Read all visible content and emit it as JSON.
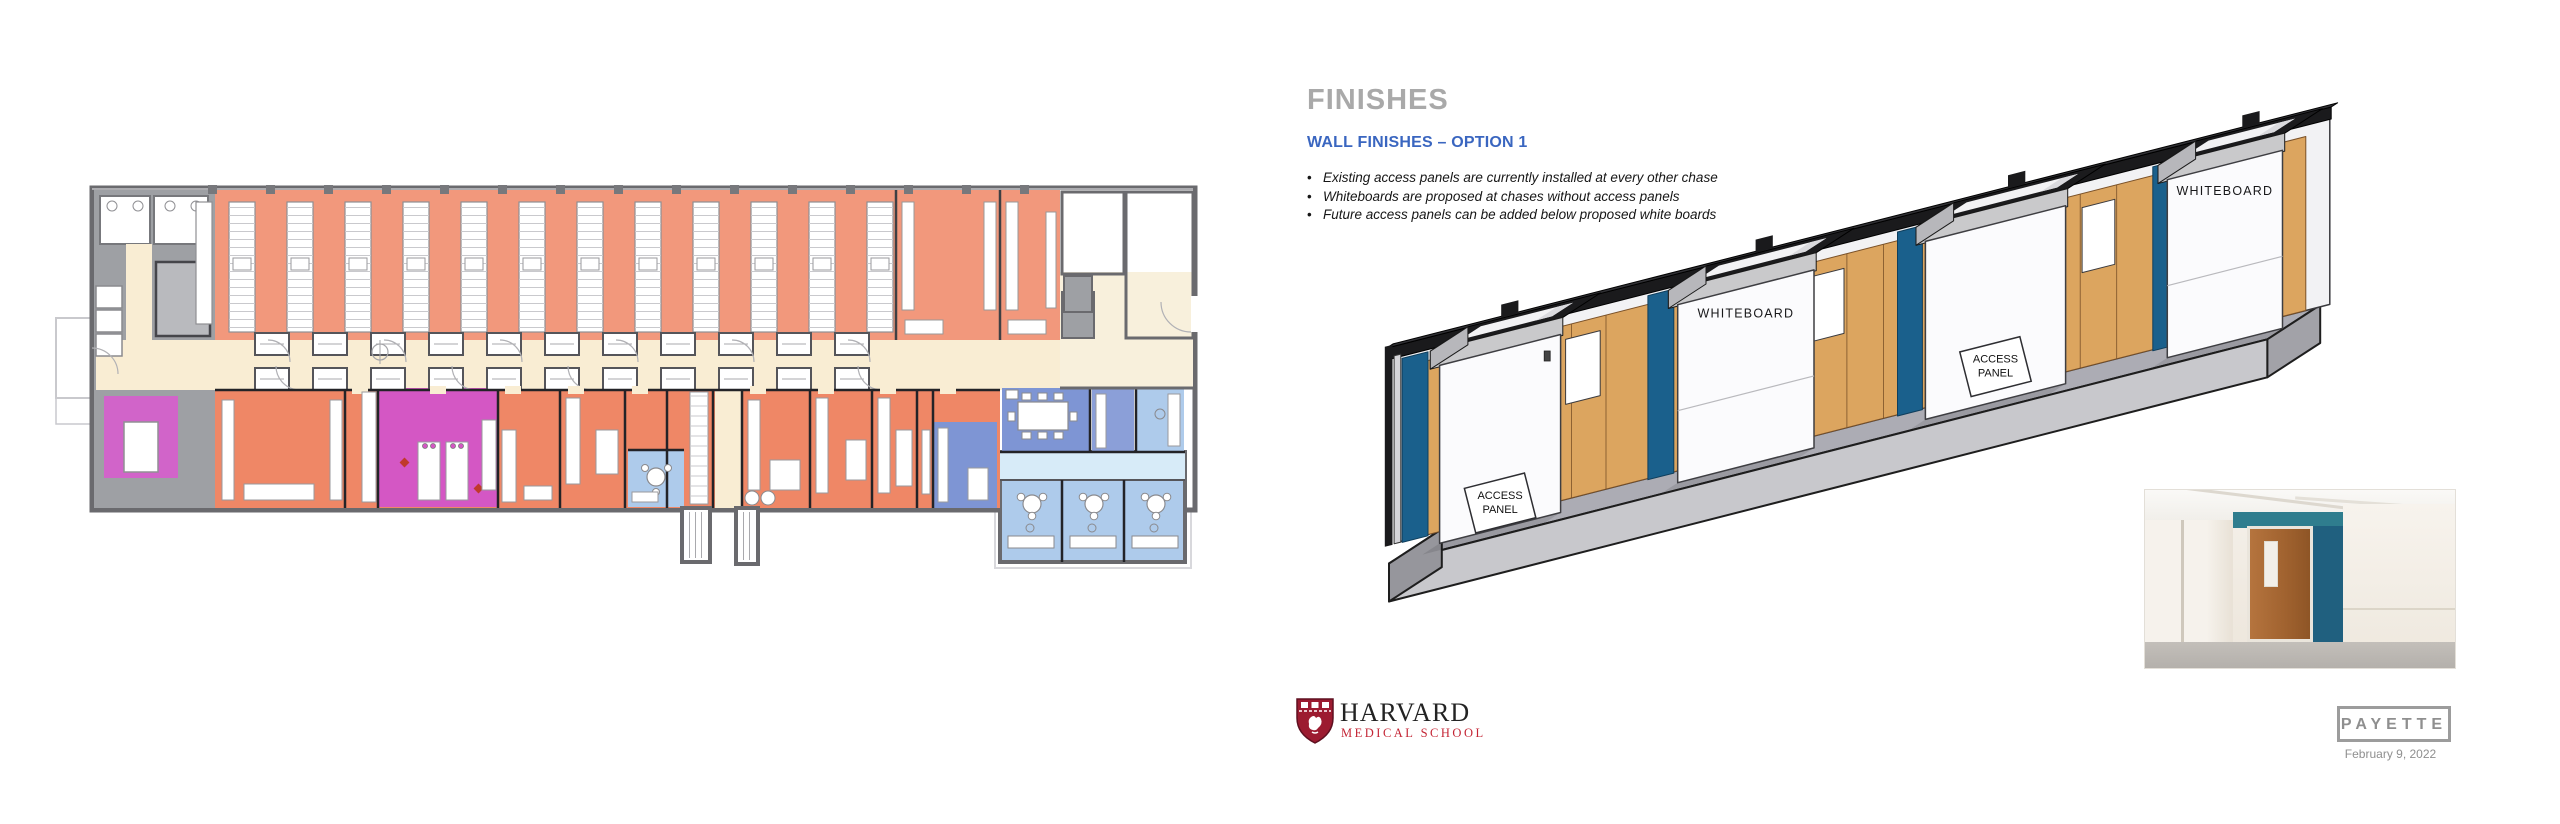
{
  "header": {
    "title": "FINISHES",
    "subtitle": "WALL FINISHES – OPTION 1",
    "bullets": [
      "Existing access panels are currently installed at every other chase",
      "Whiteboards are proposed at chases without access panels",
      "Future access panels can be added below proposed white boards"
    ]
  },
  "axon": {
    "chases": [
      {
        "label": "ACCESS PANEL",
        "label_style": "boxed"
      },
      {
        "label": "WHITEBOARD",
        "label_style": "plain"
      },
      {
        "label": "ACCESS PANEL",
        "label_style": "boxed"
      },
      {
        "label": "WHITEBOARD",
        "label_style": "plain"
      }
    ],
    "colors": {
      "wood": "#DCA55F",
      "wood_outline": "#7A5128",
      "accent_blue": "#1A608C",
      "floor_top": "#ACACB4",
      "floor_front": "#C8C8CC",
      "floor_side": "#96969C",
      "wall_white": "#F2F2F4",
      "chase_white": "#FBFBFD",
      "rim_dark": "#1B1B1D",
      "rim_gray": "#C9C9CB",
      "outline": "#1E1E1E"
    }
  },
  "floor_plan": {
    "bench_columns": 12,
    "colors": {
      "lab_zone_salmon": "#F2987C",
      "support_zone_coral": "#EF8766",
      "equipment_magenta": "#D457C4",
      "elevator_magenta": "#D164C9",
      "corridor_cream": "#F9EDD3",
      "office_blue": "#AECBEB",
      "meeting_blue": "#7E95D4",
      "pantry_blue": "#8B9FD8",
      "wing_corridor_blue": "#D7EBF8",
      "core_gray": "#9EA0A4",
      "wall_gray": "#6A6A6E",
      "partition_dark": "#232327"
    }
  },
  "photo": {
    "door_wood": "#A0622F",
    "accent_teal": "#20607F",
    "header_teal": "#2F7D8E"
  },
  "footer": {
    "harvard_line1": "HARVARD",
    "harvard_line2": "MEDICAL SCHOOL",
    "payette_logo": "PAYETTE",
    "date": "February 9, 2022"
  }
}
